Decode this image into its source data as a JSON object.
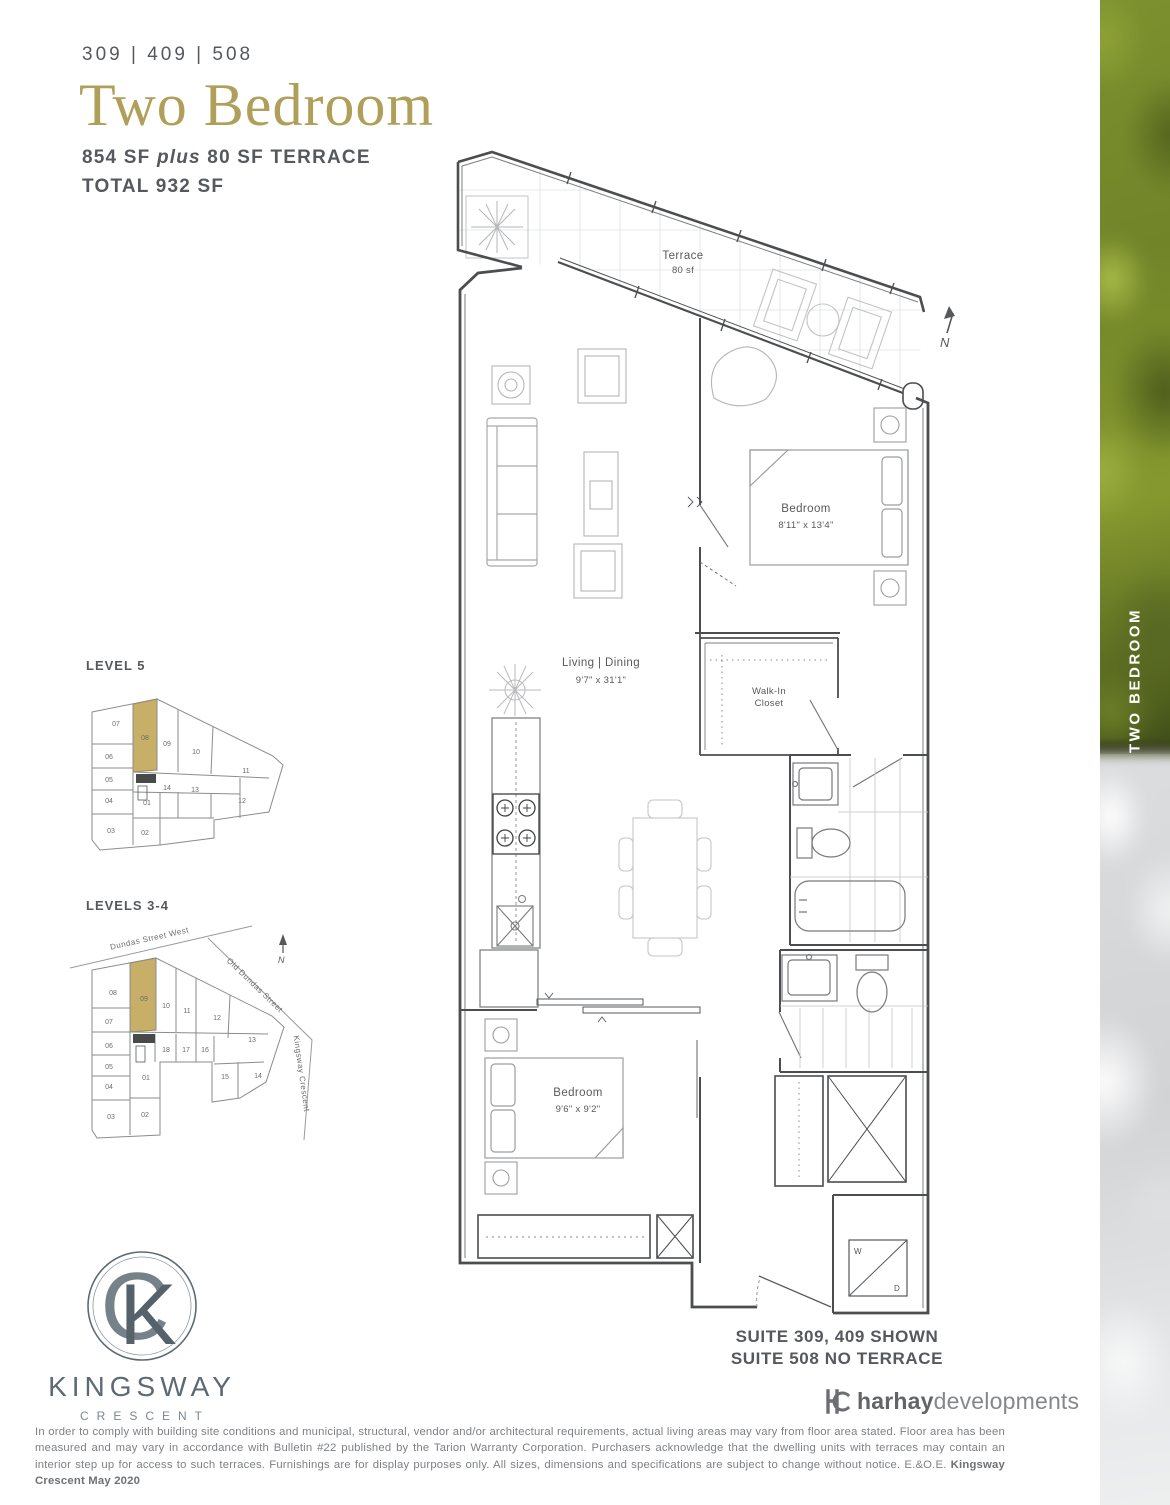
{
  "header": {
    "unit_numbers": "309 | 409 | 508",
    "title": "Two Bedroom",
    "area_sf": "854 SF",
    "area_plus": "plus",
    "area_terrace": "80 SF TERRACE",
    "total": "TOTAL 932 SF"
  },
  "keyplan_level5": {
    "label": "LEVEL 5",
    "highlighted_unit": "08",
    "units": [
      "07",
      "08",
      "09",
      "10",
      "11",
      "06",
      "05",
      "04",
      "03",
      "02",
      "01",
      "14",
      "13",
      "12"
    ]
  },
  "keyplan_levels34": {
    "label": "LEVELS 3-4",
    "highlighted_unit": "09",
    "north": "N",
    "streets": {
      "street1": "Dundas Street West",
      "street2": "Old Dundas Street",
      "street3": "Kingsway Crescent"
    },
    "units": [
      "08",
      "09",
      "10",
      "11",
      "12",
      "13",
      "07",
      "06",
      "05",
      "04",
      "03",
      "02",
      "01",
      "18",
      "17",
      "16",
      "15",
      "14"
    ]
  },
  "floorplan": {
    "north": "N",
    "terrace_name": "Terrace",
    "terrace_area": "80 sf",
    "bedroom1_name": "Bedroom",
    "bedroom1_dims": "8'11\" x 13'4\"",
    "living_name": "Living | Dining",
    "living_dims": "9'7\" x 31'1\"",
    "closet_line1": "Walk-In",
    "closet_line2": "Closet",
    "bedroom2_name": "Bedroom",
    "bedroom2_dims": "9'6\" x 9'2\"",
    "washer": "W",
    "dryer": "D",
    "suite_note_line1": "SUITE 309, 409 SHOWN",
    "suite_note_line2": "SUITE 508 NO TERRACE"
  },
  "sidebar": {
    "vertical_label": "TWO BEDROOM"
  },
  "branding": {
    "monogram_c": "C",
    "monogram_k": "K",
    "name": "KINGSWAY",
    "sub": "CRESCENT",
    "developer_bold": "harhay",
    "developer_light": "developments"
  },
  "disclaimer": {
    "body": "In order to comply with building site conditions and municipal, structural, vendor and/or architectural requirements, actual living areas may vary from floor area stated. Floor area has been measured and may vary in accordance with Bulletin #22 published by the Tarion Warranty Corporation. Purchasers acknowledge that the dwelling units with terraces may contain an interior step up for access to such terraces. Furnishings are for display purposes only. All sizes, dimensions and specifications are subject to change without notice. E.&O.E. ",
    "emphasis": "Kingsway Crescent May 2020"
  },
  "colors": {
    "title_gold": "#b09f58",
    "keyplan_gold": "#c8af68",
    "ink": "#55585c",
    "wall": "#4b4d4f"
  }
}
